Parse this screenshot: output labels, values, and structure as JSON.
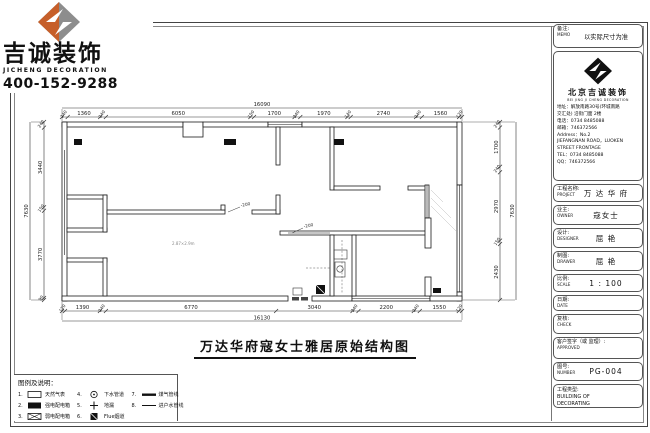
{
  "logo": {
    "name_cn": "吉诚装饰",
    "name_en": "JICHENG DECORATION",
    "phone": "400-152-9288"
  },
  "drawing_title": "万达华府寇女士雅居原始结构图",
  "plan": {
    "total_top": "16090",
    "total_bottom": "16130",
    "total_left": "7630",
    "total_right": "7630",
    "dims_top": [
      "240",
      "1360",
      "240",
      "6050",
      "150",
      "1700",
      "240",
      "1970",
      "140",
      "2740",
      "240",
      "1560",
      "120"
    ],
    "dims_bottom": [
      "120",
      "1390",
      "240",
      "6770",
      "3040",
      "240",
      "2200",
      "240",
      "1550",
      "120"
    ],
    "dims_left": [
      "240",
      "3440",
      "150",
      "3770",
      "90"
    ],
    "dims_right": [
      "240",
      "1700",
      "240",
      "2970",
      "150",
      "2430"
    ],
    "annotations": [
      "-200",
      "-200"
    ],
    "note": "2.87×2.9m"
  },
  "legend": {
    "title": "图例及说明：",
    "items": [
      {
        "num": "1.",
        "symbol": "rect-outline",
        "label": "天然气表"
      },
      {
        "num": "2.",
        "symbol": "rect-filled",
        "label": "强电配电箱"
      },
      {
        "num": "3.",
        "symbol": "rect-x",
        "label": "弱电配电箱"
      },
      {
        "num": "4.",
        "symbol": "circle-dot",
        "label": "下水管道"
      },
      {
        "num": "5.",
        "symbol": "plus",
        "label": "地漏"
      },
      {
        "num": "6.",
        "symbol": "square-filled",
        "label": "Flue烟道"
      },
      {
        "num": "7.",
        "symbol": "thick-line",
        "label": "煤气管线"
      },
      {
        "num": "8.",
        "symbol": "thin-line",
        "label": "进户水管线"
      }
    ]
  },
  "title_block": {
    "memo": {
      "label_cn": "备注:",
      "label_en": "MEMO",
      "value": "以实际尺寸为准"
    },
    "company": {
      "name_cn": "北京吉诚装饰",
      "name_en": "BEI JING JI CHENG DECORATION",
      "lines": [
        "地址：解放南路30号(环城南路",
        "交汇处) 沿街门面 2楼",
        "电话：0734 8485088",
        "邮箱：746372566",
        "Address：No.2",
        "JIEFANGNAN ROAD，LUOKEN",
        "STREET FRONTAGE",
        "TEL：0734 8485088",
        "QQ：746372566"
      ]
    },
    "project": {
      "label_cn": "工程名称:",
      "label_en": "PROJECT",
      "value": "万 达 华 府"
    },
    "owner": {
      "label_cn": "业主:",
      "label_en": "OWNER",
      "value": "寇女士"
    },
    "designer": {
      "label_cn": "设计:",
      "label_en": "DESIGNER",
      "value": "屈 艳"
    },
    "drawer": {
      "label_cn": "制图:",
      "label_en": "DRAWER",
      "value": "屈 艳"
    },
    "scale": {
      "label_cn": "比例:",
      "label_en": "SCALE",
      "value": "1 : 100"
    },
    "date": {
      "label_cn": "日期:",
      "label_en": "DATE",
      "value": ""
    },
    "check": {
      "label_cn": "复核:",
      "label_en": "CHECK",
      "value": ""
    },
    "approved": {
      "label_cn": "客户签字（或 监理）:",
      "label_en": "APPROVED",
      "value": ""
    },
    "number": {
      "label_cn": "图号:",
      "label_en": "NUMBER",
      "value": "PG-004"
    },
    "type": {
      "label_cn": "工程类型:",
      "label_en": "BUILDING OF",
      "value": "DECORATING"
    }
  }
}
